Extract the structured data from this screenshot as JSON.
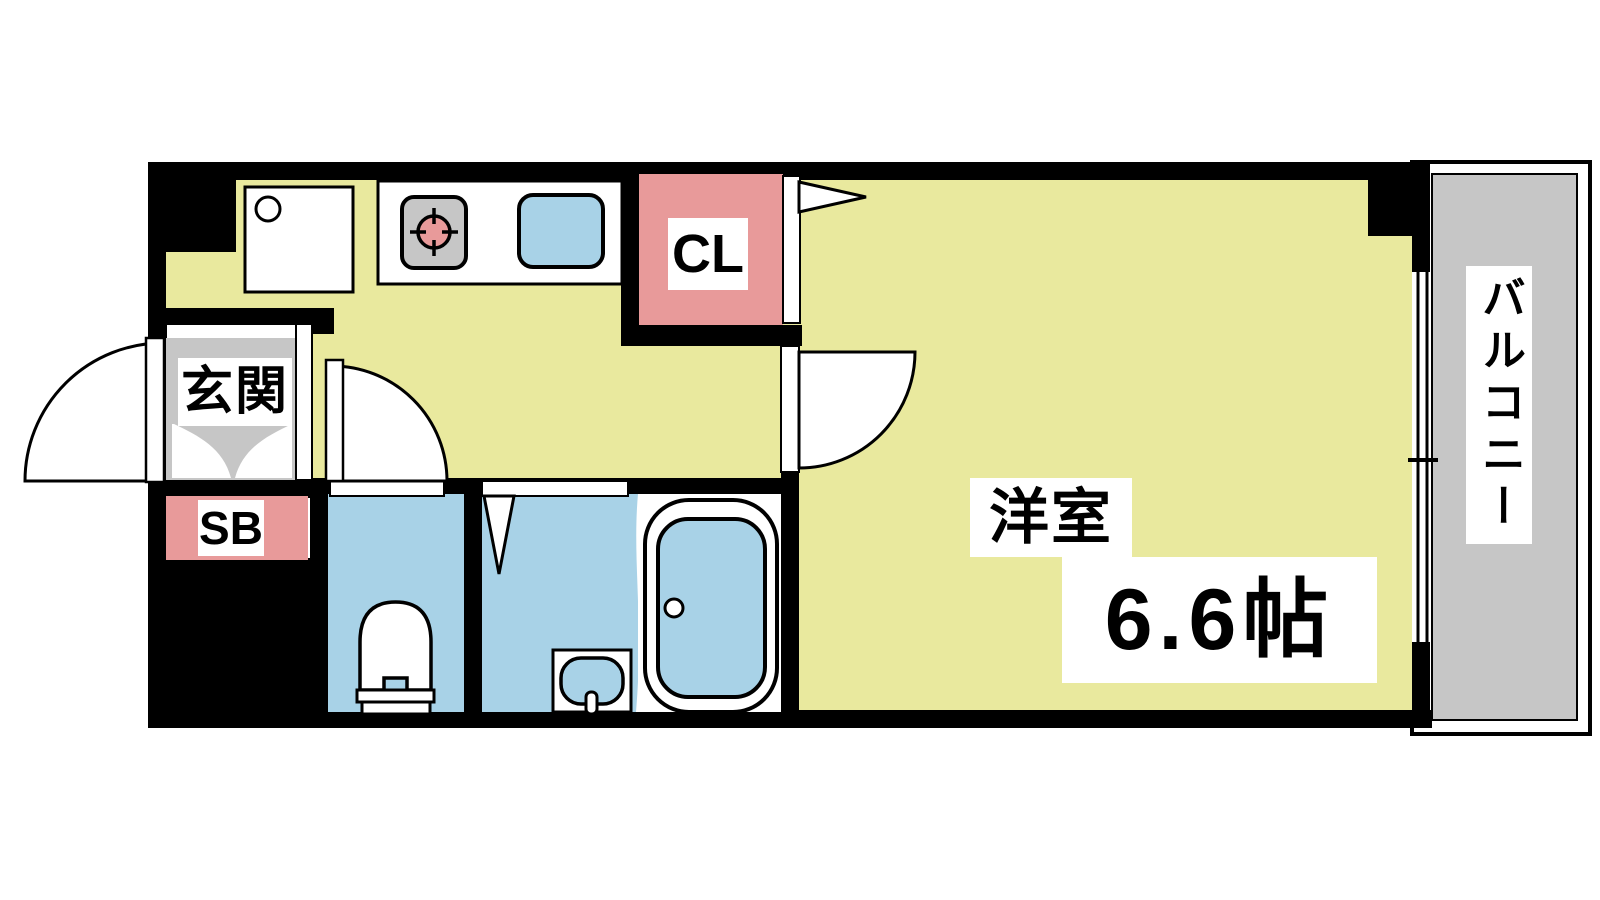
{
  "colors": {
    "wall": "#000000",
    "floor_yellow": "#e9e99e",
    "accent_pink": "#e89a9a",
    "water_blue": "#a8d2e7",
    "gray": "#c6c6c6"
  },
  "rooms": {
    "entrance": {
      "label": "玄関"
    },
    "shoe_box": {
      "label": "SB"
    },
    "closet": {
      "label": "CL"
    },
    "western_room": {
      "label": "洋室",
      "size": "6.6帖"
    },
    "balcony": {
      "label": "バルコニー"
    }
  },
  "fixtures": {
    "kitchen": [
      "washing-machine-pan-icon",
      "gas-stove-icon",
      "kitchen-sink-icon"
    ],
    "sanitary": [
      "toilet-icon",
      "washbasin-icon",
      "bathtub-icon"
    ],
    "openings": [
      "front-door-swing",
      "toilet-door-swing",
      "room-door-swing",
      "folding-bath-door",
      "closet-door",
      "balcony-sliding-window"
    ]
  }
}
